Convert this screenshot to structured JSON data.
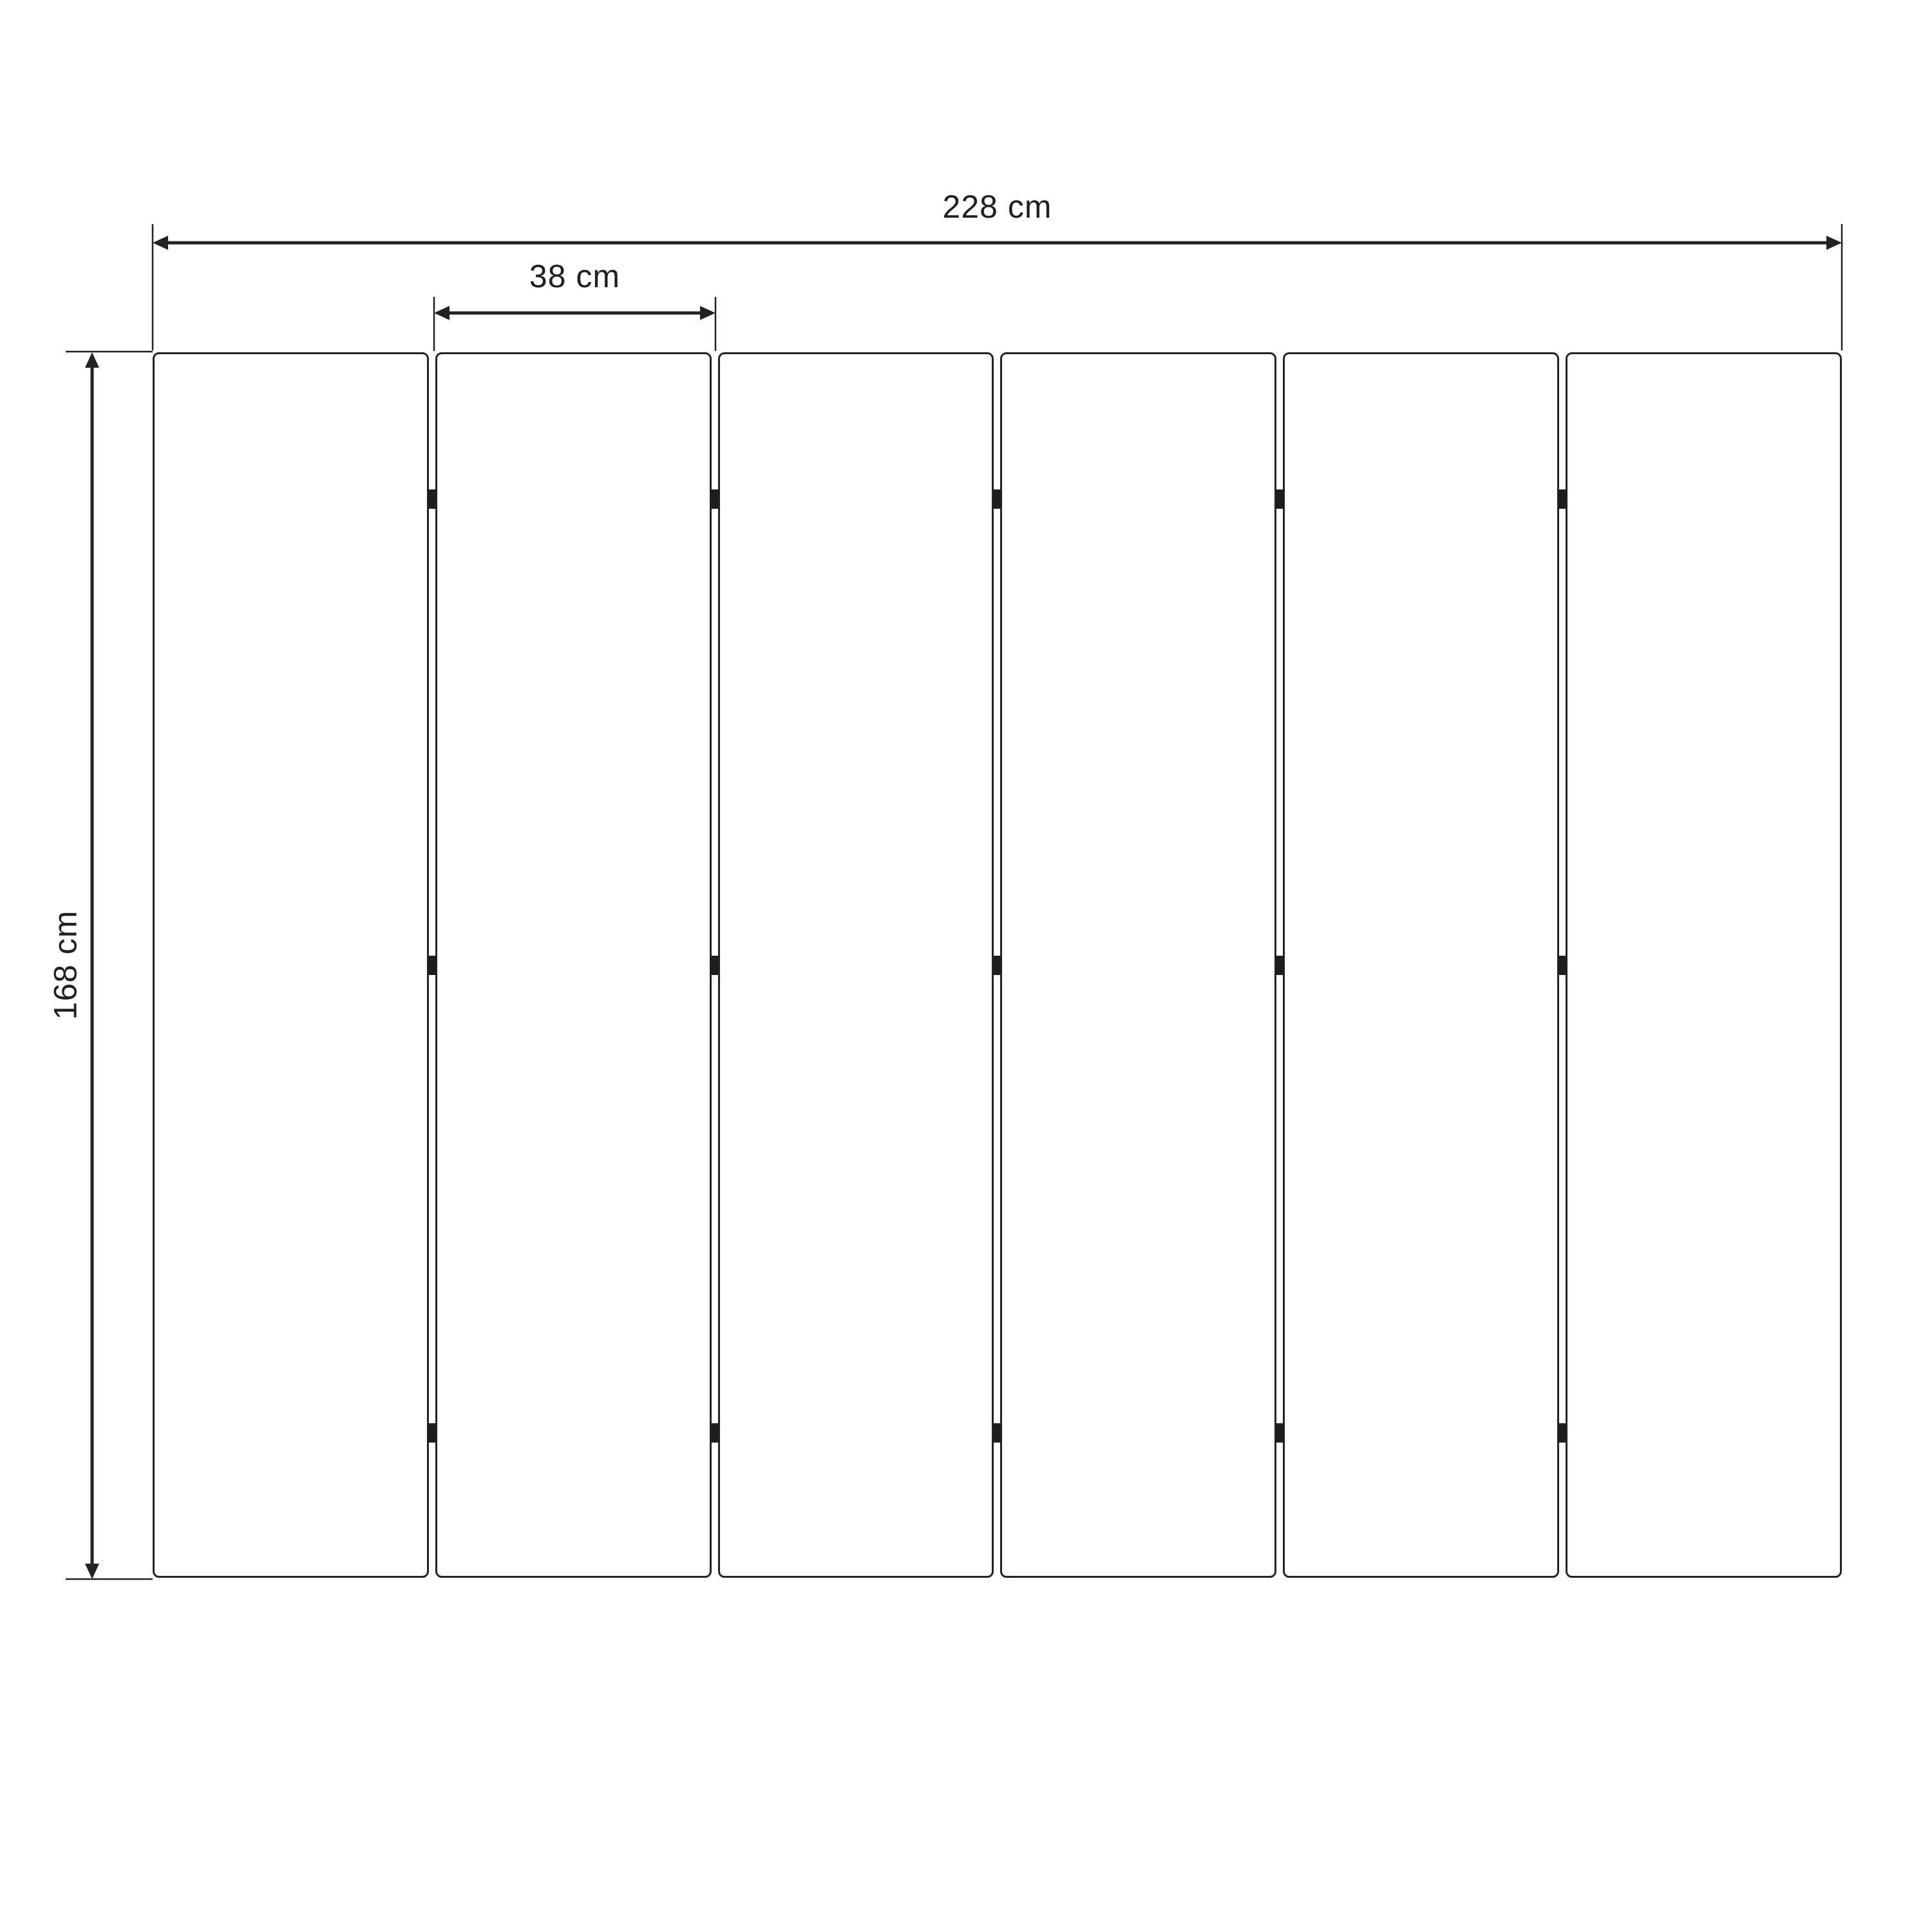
{
  "diagram": {
    "type": "dimension-drawing",
    "subject": "six-panel folding screen, front view",
    "panels": {
      "count": 6,
      "joint_count": 5,
      "hinges_per_joint": 3
    },
    "dimensions": {
      "total_width": {
        "label": "228 cm"
      },
      "panel_width": {
        "label": "38 cm"
      },
      "height": {
        "label": "168 cm"
      }
    },
    "colors": {
      "line": "#222222",
      "panel_border": "#242424",
      "hinge": "#1e1e1e",
      "background": "#ffffff"
    }
  }
}
